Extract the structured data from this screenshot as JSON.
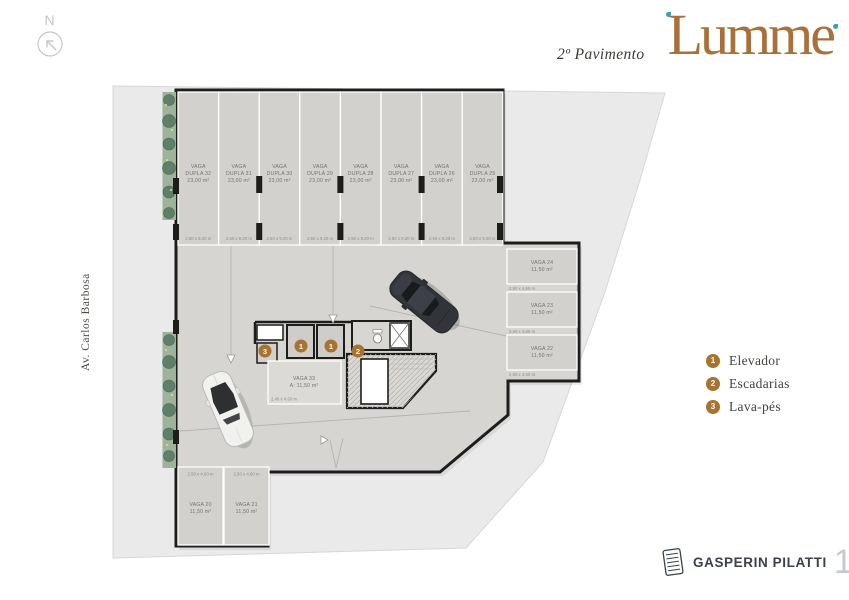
{
  "header": {
    "floor_label": "2º Pavimento",
    "brand": "Lumme"
  },
  "compass": {
    "label": "N"
  },
  "street": {
    "label": "Av. Carlos Barbosa"
  },
  "legend": {
    "items": [
      {
        "num": "1",
        "label": "Elevador"
      },
      {
        "num": "2",
        "label": "Escadarias"
      },
      {
        "num": "3",
        "label": "Lava-pés"
      }
    ]
  },
  "footer": {
    "company": "GASPERIN PILATTI",
    "years_number": "15",
    "years_label": "ANOS"
  },
  "plan": {
    "double_stalls": [
      {
        "l1": "VAGA",
        "l2": "DUPLA 32",
        "area": "23,00 m²",
        "dim": "2,50 x 9,20 m"
      },
      {
        "l1": "VAGA",
        "l2": "DUPLA 31",
        "area": "23,00 m²",
        "dim": "2,50 x 9,20 m"
      },
      {
        "l1": "VAGA",
        "l2": "DUPLA 30",
        "area": "23,00 m²",
        "dim": "2,50 x 9,20 m"
      },
      {
        "l1": "VAGA",
        "l2": "DUPLA 29",
        "area": "23,00 m²",
        "dim": "2,50 x 9,20 m"
      },
      {
        "l1": "VAGA",
        "l2": "DUPLA 28",
        "area": "23,00 m²",
        "dim": "2,50 x 9,20 m"
      },
      {
        "l1": "VAGA",
        "l2": "DUPLA 27",
        "area": "23,00 m²",
        "dim": "2,50 x 9,20 m"
      },
      {
        "l1": "VAGA",
        "l2": "DUPLA 26",
        "area": "23,00 m²",
        "dim": "2,50 x 9,20 m"
      },
      {
        "l1": "VAGA",
        "l2": "DUPLA 25",
        "area": "23,00 m²",
        "dim": "2,50 x 9,20 m"
      }
    ],
    "right_stalls": [
      {
        "name": "VAGA 24",
        "area": "11,50 m²",
        "dim": "2,50 x 4,60 m"
      },
      {
        "name": "VAGA 23",
        "area": "11,50 m²",
        "dim": "2,50 x 4,60 m"
      },
      {
        "name": "VAGA 22",
        "area": "11,50 m²",
        "dim": "2,50 x 4,60 m"
      }
    ],
    "bottom_stalls": [
      {
        "name": "VAGA 20",
        "area": "11,50 m²",
        "dim": "2,50 x 4,60 m"
      },
      {
        "name": "VAGA 21",
        "area": "11,50 m²",
        "dim": "2,50 x 4,60 m"
      }
    ],
    "vaga33": {
      "name": "VAGA 33",
      "area": "A: 11,50 m²",
      "dim": "2,46 x 4,60 m"
    },
    "markers": {
      "m1": "1",
      "m2": "2",
      "m3": "3"
    }
  },
  "colors": {
    "brand_gold": "#a8713a",
    "brand_teal": "#3fa3a3",
    "marker": "#a7732e",
    "lot": "#eaeaeb",
    "slab": "#d7d5d2",
    "stall": "#d3d1ce",
    "wall": "#1d1d1b"
  }
}
